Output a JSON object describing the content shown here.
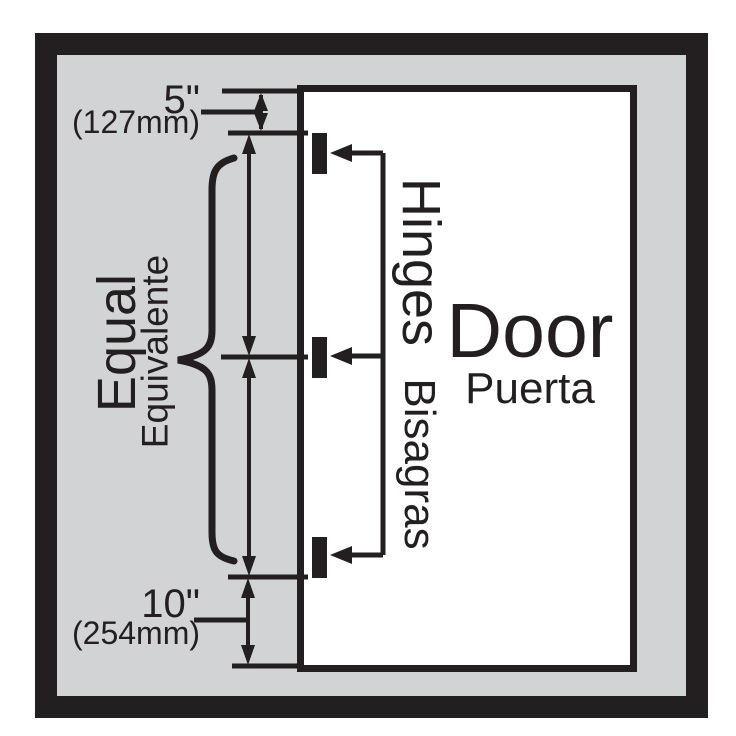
{
  "diagram": {
    "colors": {
      "page_background": "#ffffff",
      "panel_background": "#d2d3d5",
      "line_black": "#231f20",
      "door_fill": "#ffffff"
    },
    "top_dimension": {
      "inches": "5\"",
      "metric": "(127mm)"
    },
    "bottom_dimension": {
      "inches": "10\"",
      "metric": "(254mm)"
    },
    "spacing": {
      "en": "Equal",
      "es": "Equivalente"
    },
    "hinges": {
      "en": "Hinges",
      "es": "Bisagras",
      "count": 3
    },
    "door": {
      "en": "Door",
      "es": "Puerta"
    }
  }
}
